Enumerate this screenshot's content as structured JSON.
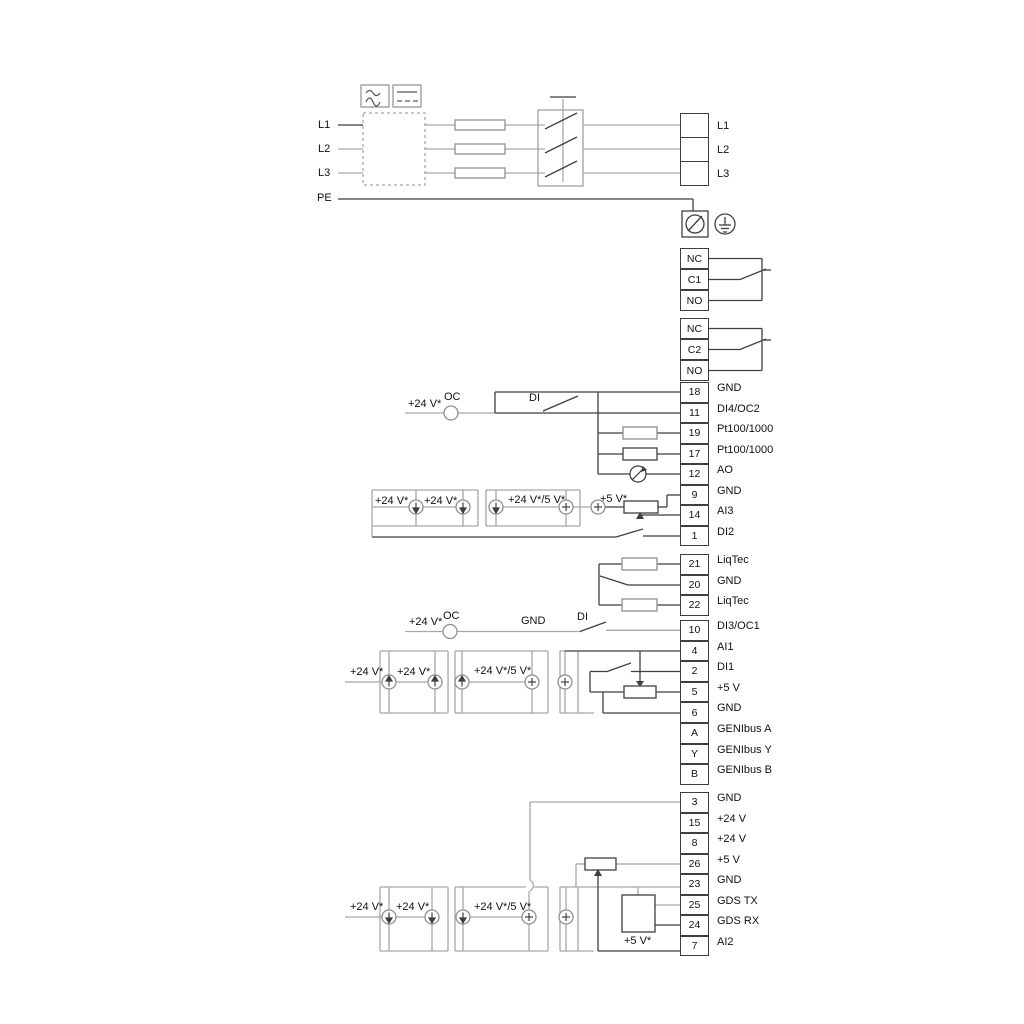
{
  "power": {
    "in_labels": [
      "L1",
      "L2",
      "L3",
      "PE"
    ],
    "out_labels": [
      "L1",
      "L2",
      "L3"
    ]
  },
  "relays": {
    "r1": [
      "NC",
      "C1",
      "NO"
    ],
    "r2": [
      "NC",
      "C2",
      "NO"
    ]
  },
  "terminals": {
    "t1": [
      {
        "num": "18",
        "label": "GND"
      },
      {
        "num": "11",
        "label": "DI4/OC2"
      },
      {
        "num": "19",
        "label": "Pt100/1000"
      },
      {
        "num": "17",
        "label": "Pt100/1000"
      },
      {
        "num": "12",
        "label": "AO"
      },
      {
        "num": "9",
        "label": "GND"
      },
      {
        "num": "14",
        "label": "AI3"
      },
      {
        "num": "1",
        "label": "DI2"
      }
    ],
    "t2": [
      {
        "num": "21",
        "label": "LiqTec"
      },
      {
        "num": "20",
        "label": "GND"
      },
      {
        "num": "22",
        "label": "LiqTec"
      }
    ],
    "t3": [
      {
        "num": "10",
        "label": "DI3/OC1"
      },
      {
        "num": "4",
        "label": "AI1"
      },
      {
        "num": "2",
        "label": "DI1"
      },
      {
        "num": "5",
        "label": "+5 V"
      },
      {
        "num": "6",
        "label": "GND"
      },
      {
        "num": "A",
        "label": "GENIbus A"
      },
      {
        "num": "Y",
        "label": "GENIbus Y"
      },
      {
        "num": "B",
        "label": "GENIbus B"
      }
    ],
    "t4": [
      {
        "num": "3",
        "label": "GND"
      },
      {
        "num": "15",
        "label": "+24 V"
      },
      {
        "num": "8",
        "label": "+24 V"
      },
      {
        "num": "26",
        "label": "+5 V"
      },
      {
        "num": "23",
        "label": "GND"
      },
      {
        "num": "25",
        "label": "GDS TX"
      },
      {
        "num": "24",
        "label": "GDS RX"
      },
      {
        "num": "7",
        "label": "AI2"
      }
    ]
  },
  "ann": {
    "p24_a": "+24 V*",
    "oc_a": "OC",
    "di_a": "DI",
    "r1p1": "+24 V*",
    "r1p2": "+24 V*",
    "r1mix": "+24 V*/5 V*",
    "r1v5": "+5 V*",
    "p24_b": "+24 V*",
    "oc_b": "OC",
    "gnd_b": "GND",
    "di_b": "DI",
    "r2p1": "+24 V*",
    "r2p2": "+24 V*",
    "r2mix": "+24 V*/5 V*",
    "r3p1": "+24 V*",
    "r3p2": "+24 V*",
    "r3mix": "+24 V*/5 V*",
    "r3v5": "+5 V*"
  },
  "icons": {
    "rcd_ac": "sine-wave-icon",
    "rcd_dc": "dashed-line-icon",
    "screw": "screw-terminal-icon",
    "earth": "protective-earth-icon",
    "meter": "analog-output-meter-icon",
    "current_source": "current-source-circle-icon",
    "voltage_source": "plus-source-circle-icon"
  },
  "colors": {
    "line": "#3f3f3f",
    "line_gray": "#a8a8a8",
    "text": "#111111",
    "bg": "#ffffff"
  }
}
